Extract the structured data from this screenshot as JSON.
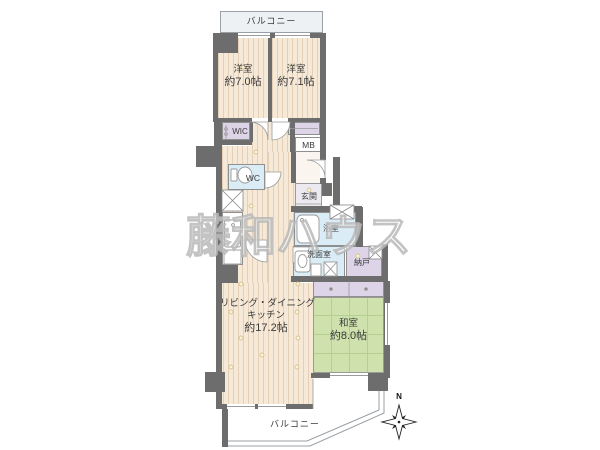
{
  "floorplan": {
    "balconies": {
      "top": "バルコニー",
      "bottom": "バルコニー"
    },
    "rooms": {
      "bedroom1": {
        "label": "洋室",
        "size": "約7.0帖"
      },
      "bedroom2": {
        "label": "洋室",
        "size": "約7.1帖"
      },
      "ldk": {
        "label1": "リビング・ダイニング",
        "label2": "キッチン",
        "size": "約17.2帖"
      },
      "japanese_room": {
        "label": "和室",
        "size": "約8.0帖"
      },
      "wic": {
        "label": "WIC"
      },
      "meter_box": {
        "label": "MB"
      },
      "toilet": {
        "label": "WC"
      },
      "entrance": {
        "label": "玄関"
      },
      "bathroom": {
        "label": "浴室"
      },
      "washroom": {
        "label": "洗面室"
      },
      "storage": {
        "label": "納戸"
      }
    },
    "compass": {
      "north": "N"
    },
    "watermark": "藤和ハウス",
    "colors": {
      "wall": "#6d6d6d",
      "floor": "#f6e9d8",
      "tatami_green": "#cfe2ad",
      "closet_purple": "#ddd4e8",
      "wet_blue": "#daedf6",
      "balcony_gray": "#eef1f4"
    }
  }
}
